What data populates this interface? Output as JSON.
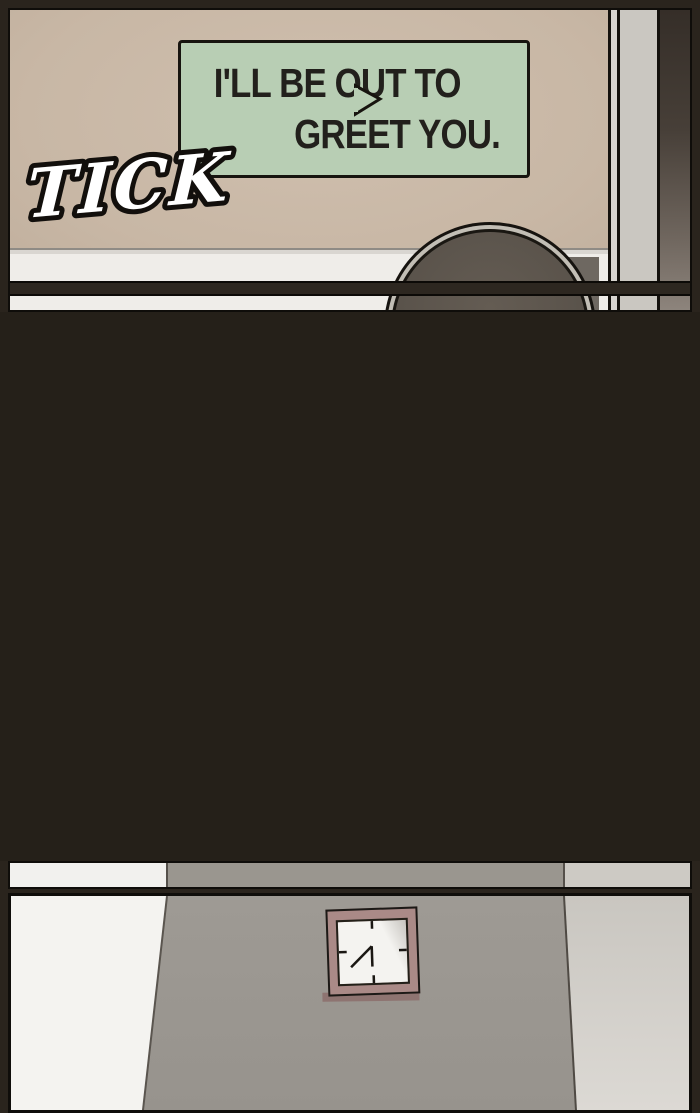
{
  "comic": {
    "panel1": {
      "description": "office wall scene",
      "speech_bubble": {
        "line1": "I'LL BE OUT TO",
        "line2": "GREET YOU.",
        "bg_color": "#b8ceb4",
        "border_color": "#17140f",
        "text_color": "#22201c"
      },
      "sfx": {
        "text": "TICK",
        "fill_color": "#ffffff",
        "outline_color": "#120f0c"
      },
      "wall_color": "#c8b7a5",
      "baseboard_color": "#efede9",
      "head_fill_color": "#5a534b"
    },
    "panel2": {
      "description": "black darkness panel",
      "bg_color": "#252019"
    },
    "panel3": {
      "description": "hallway wall with square clock",
      "wall_gray": "#9b9791",
      "wall_white": "#f4f3f0",
      "wall_light": "#cfccc6",
      "clock_frame_color": "#aa8a87",
      "clock_face_color": "#f4f3f0"
    }
  }
}
